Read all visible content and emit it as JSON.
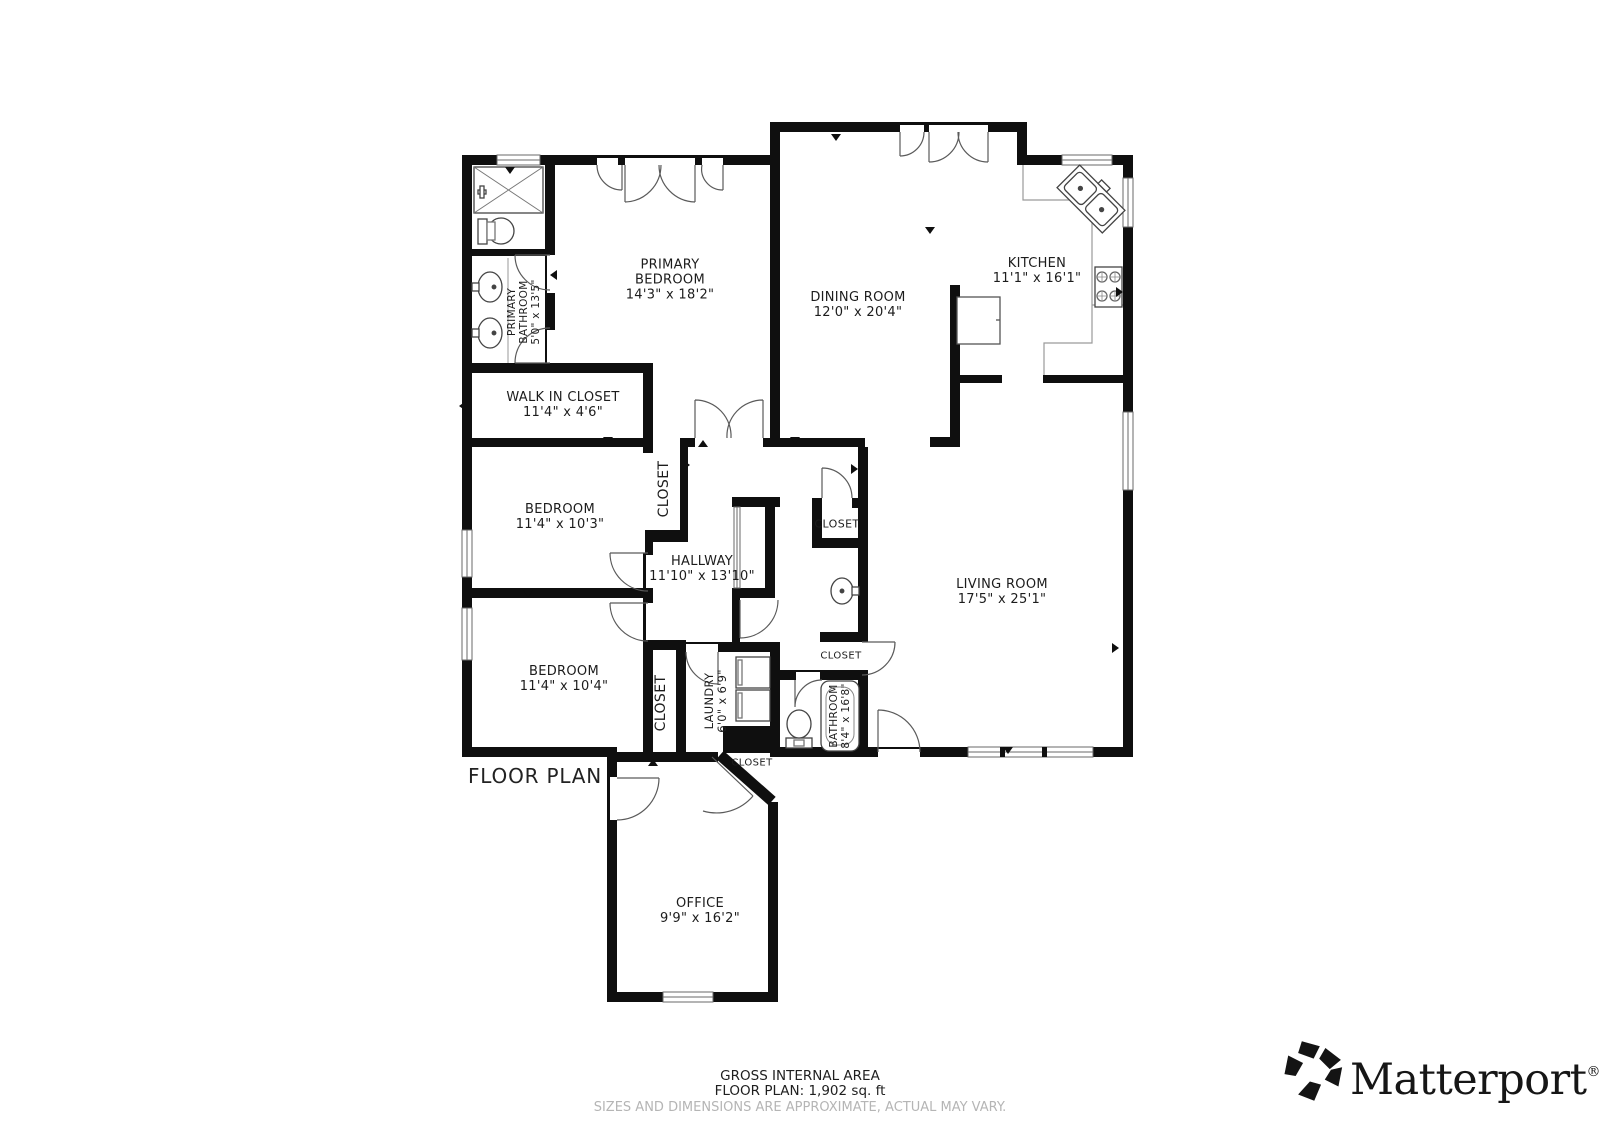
{
  "page": {
    "title": "FLOOR PLAN"
  },
  "rooms": {
    "primary_bedroom": {
      "line1": "PRIMARY",
      "line2": "BEDROOM",
      "dims": "14'3\" x 18'2\""
    },
    "dining_room": {
      "line1": "DINING ROOM",
      "dims": "12'0\" x 20'4\""
    },
    "kitchen": {
      "line1": "KITCHEN",
      "dims": "11'1\" x 16'1\""
    },
    "walk_in_closet": {
      "line1": "WALK IN CLOSET",
      "dims": "11'4\" x 4'6\""
    },
    "bedroom_1": {
      "line1": "BEDROOM",
      "dims": "11'4\" x 10'3\""
    },
    "bedroom_2": {
      "line1": "BEDROOM",
      "dims": "11'4\" x 10'4\""
    },
    "hallway": {
      "line1": "HALLWAY",
      "dims": "11'10\" x 13'10\""
    },
    "living_room": {
      "line1": "LIVING ROOM",
      "dims": "17'5\" x 25'1\""
    },
    "office": {
      "line1": "OFFICE",
      "dims": "9'9\" x 16'2\""
    },
    "primary_bathroom": {
      "line1": "PRIMARY",
      "line2": "BATHROOM",
      "dims": "5'0\" x 13'5\""
    },
    "laundry": {
      "line1": "LAUNDRY",
      "dims": "6'0\" x 6'9\""
    },
    "bathroom": {
      "line1": "BATHROOM",
      "dims": "8'4\" x 16'8\""
    }
  },
  "closet_label": "CLOSET",
  "footer": {
    "area_title": "GROSS INTERNAL AREA",
    "area_value": "FLOOR PLAN: 1,902 sq. ft",
    "disclaimer": "SIZES AND DIMENSIONS ARE APPROXIMATE, ACTUAL MAY VARY."
  },
  "brand": {
    "name": "Matterport",
    "registered": "®"
  },
  "colors": {
    "wall": "#0f0f0f",
    "door_arc": "#5a5a5a",
    "fixture": "#444444",
    "muted_text": "#b5b5b5"
  }
}
